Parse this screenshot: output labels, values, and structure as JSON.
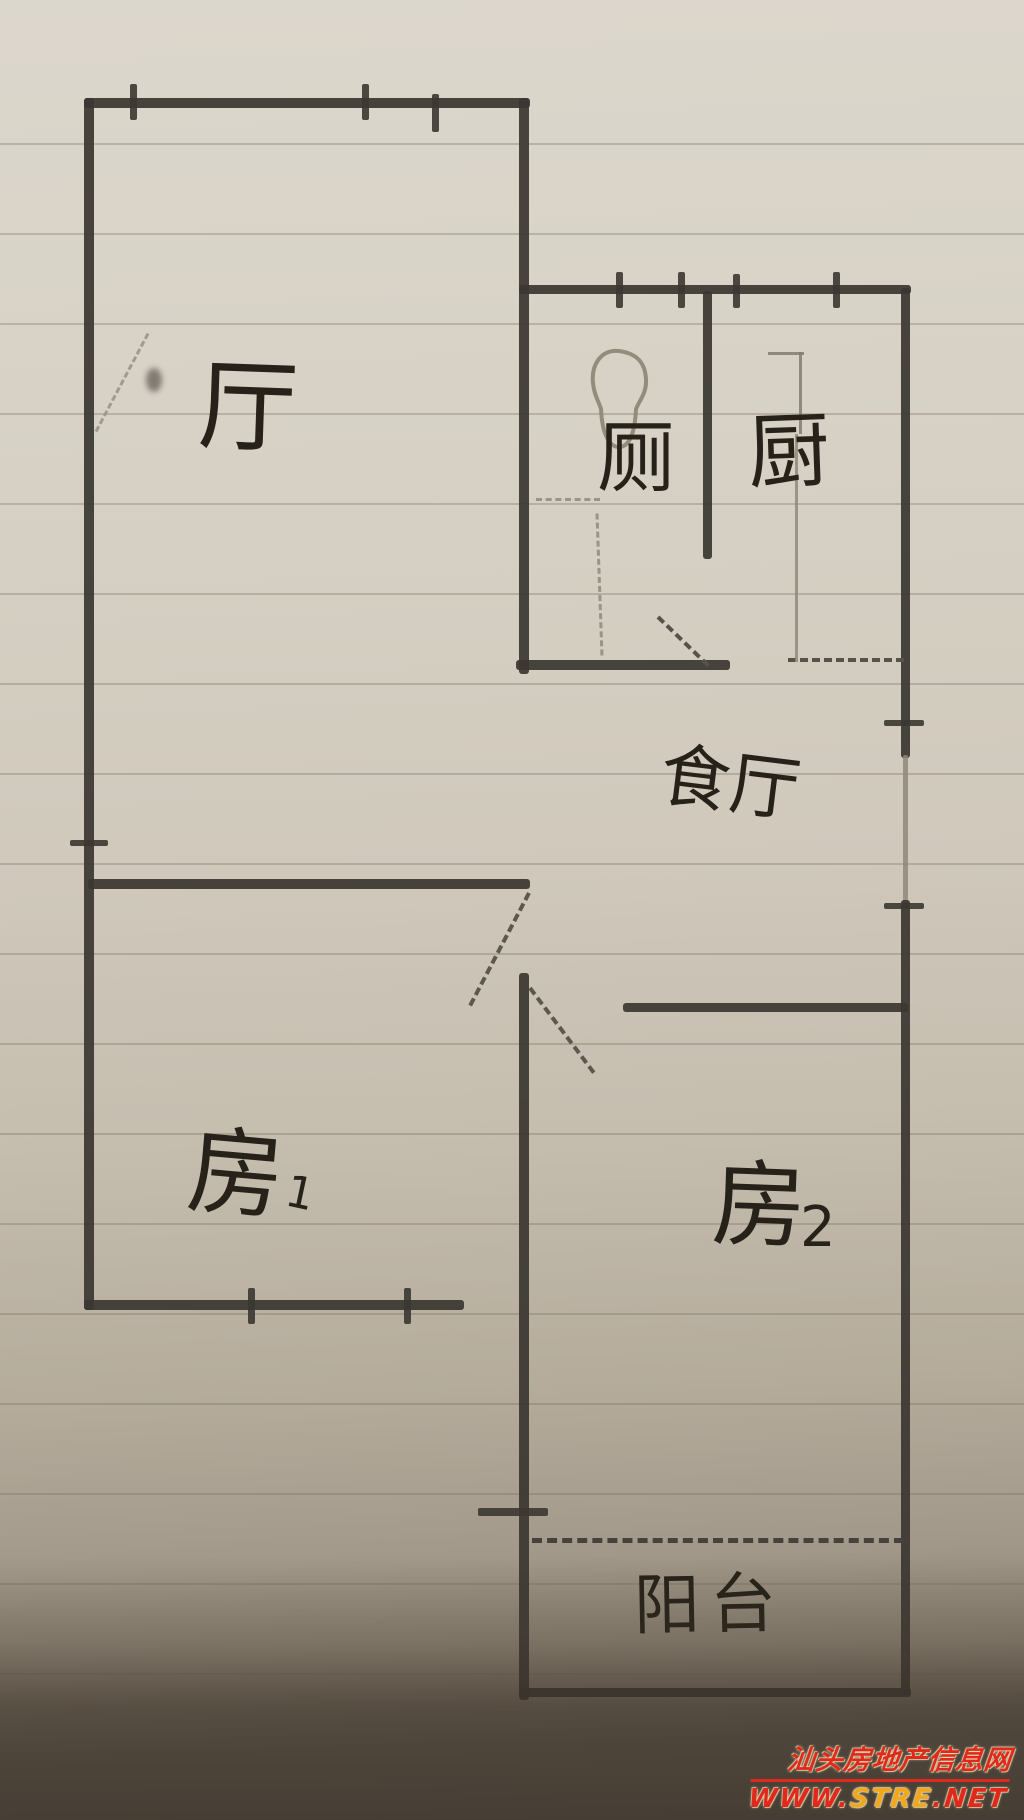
{
  "rooms": {
    "living": {
      "label": "厅"
    },
    "toilet": {
      "label": "厕"
    },
    "kitchen": {
      "label": "厨"
    },
    "dining": {
      "label": "食厅"
    },
    "bedroom1": {
      "label_char": "房",
      "label_num": "1"
    },
    "bedroom2": {
      "label_char": "房",
      "label_num": "2"
    },
    "balcony": {
      "label": "阳台"
    }
  },
  "icons": {
    "toilet_fixture": "toilet-bowl-outline"
  },
  "watermark": {
    "site_name": "汕头房地产信息网",
    "url_prefix": "WWW.",
    "url_highlight": "STRE",
    "url_suffix": ".NET"
  },
  "palette": {
    "pencil_dark": "#3b3731",
    "pencil_light": "#8f8779",
    "paper": "#d6d0c4",
    "watermark_red": "#e0281c",
    "watermark_yellow": "#f2a81d"
  }
}
